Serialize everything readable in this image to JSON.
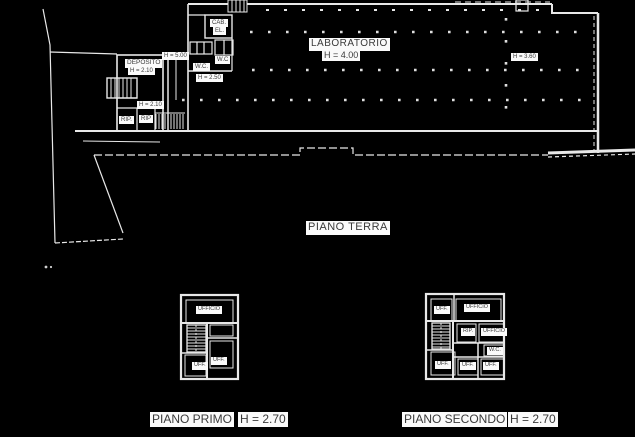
{
  "colors": {
    "background": "#000000",
    "line": "#e8e8e8",
    "label_bg": "#fafafa",
    "label_text": "#3a3a3a"
  },
  "plan": {
    "ground": {
      "name": "PIANO TERRA",
      "laboratorio": "LABORATORIO",
      "laboratorio_h": "H = 4.00",
      "deposito": "DEPOSITO",
      "deposito_h": "H = 2.10",
      "h_500": "H = 5.00",
      "h_250": "H = 2.50",
      "h_210": "H = 2.10",
      "h_360": "H = 3.60",
      "cab": "CAB.",
      "el": "EL.",
      "wc_a": "W.C",
      "wc_b": "W.C.",
      "rip_a": "RIP.",
      "rip_b": "RIP"
    },
    "first": {
      "caption": "PIANO PRIMO",
      "caption_h": "H = 2.70",
      "ufficio": "UFFICIO",
      "uff_left": "UFF.",
      "uff_right": "UFF."
    },
    "second": {
      "caption": "PIANO SECONDO",
      "caption_h": "H = 2.70",
      "uff_tl": "UFF.",
      "ufficio_top": "UFFICIO",
      "rip": "RIP.",
      "ufficio_mid": "UFFICIO",
      "wc": "W.C.",
      "uff_bl": "UFF.",
      "uff_bm": "UFF.",
      "uff_br": "UFF."
    }
  }
}
